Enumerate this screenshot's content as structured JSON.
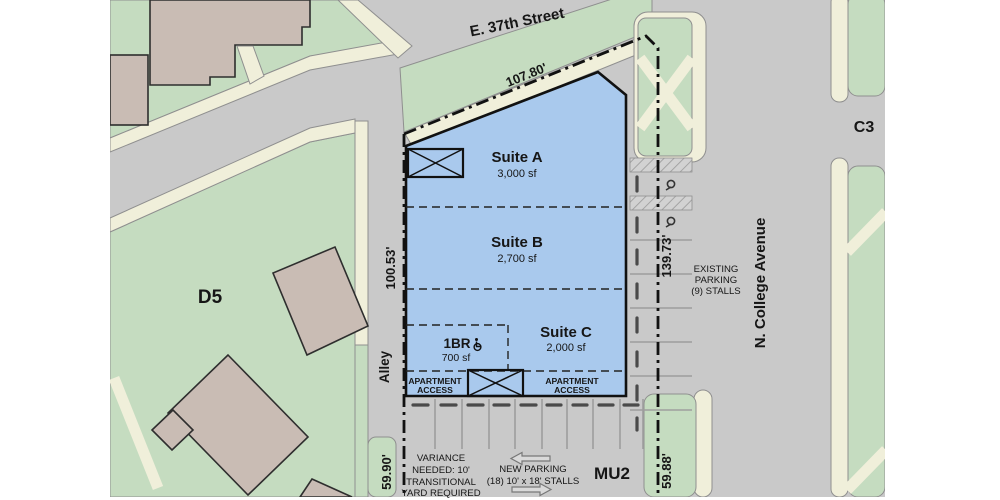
{
  "streets": {
    "east": "E. 37th Street",
    "avenue": "N. College Avenue",
    "alley": "Alley"
  },
  "zones": {
    "d5": "D5",
    "c3": "C3",
    "mu2": "MU2"
  },
  "dims": {
    "north": "107.80'",
    "west": "100.53'",
    "east": "139.73'",
    "sw": "59.90'",
    "se": "59.88'"
  },
  "suites": [
    {
      "name": "Suite A",
      "area": "3,000 sf"
    },
    {
      "name": "Suite B",
      "area": "2,700 sf"
    },
    {
      "name": "Suite C",
      "area": "2,000 sf"
    }
  ],
  "apartment": {
    "name": "1BR",
    "area": "700 sf"
  },
  "access": {
    "line1": "APARTMENT",
    "line2": "ACCESS"
  },
  "existing_parking": {
    "line1": "EXISTING",
    "line2": "PARKING",
    "line3": "(9) STALLS"
  },
  "new_parking": {
    "line1": "NEW PARKING",
    "line2": "(18) 10' x 18' STALLS"
  },
  "variance": {
    "line1": "VARIANCE",
    "line2": "NEEDED: 10'",
    "line3": "TRANSITIONAL",
    "line4": "YARD REQUIRED"
  },
  "colors": {
    "street_gray": "#c9c9c9",
    "green": "#c5dcc0",
    "cream": "#f0efda",
    "tan": "#c9bcb4",
    "blue": "#a9c9ed",
    "line_black": "#111111"
  }
}
